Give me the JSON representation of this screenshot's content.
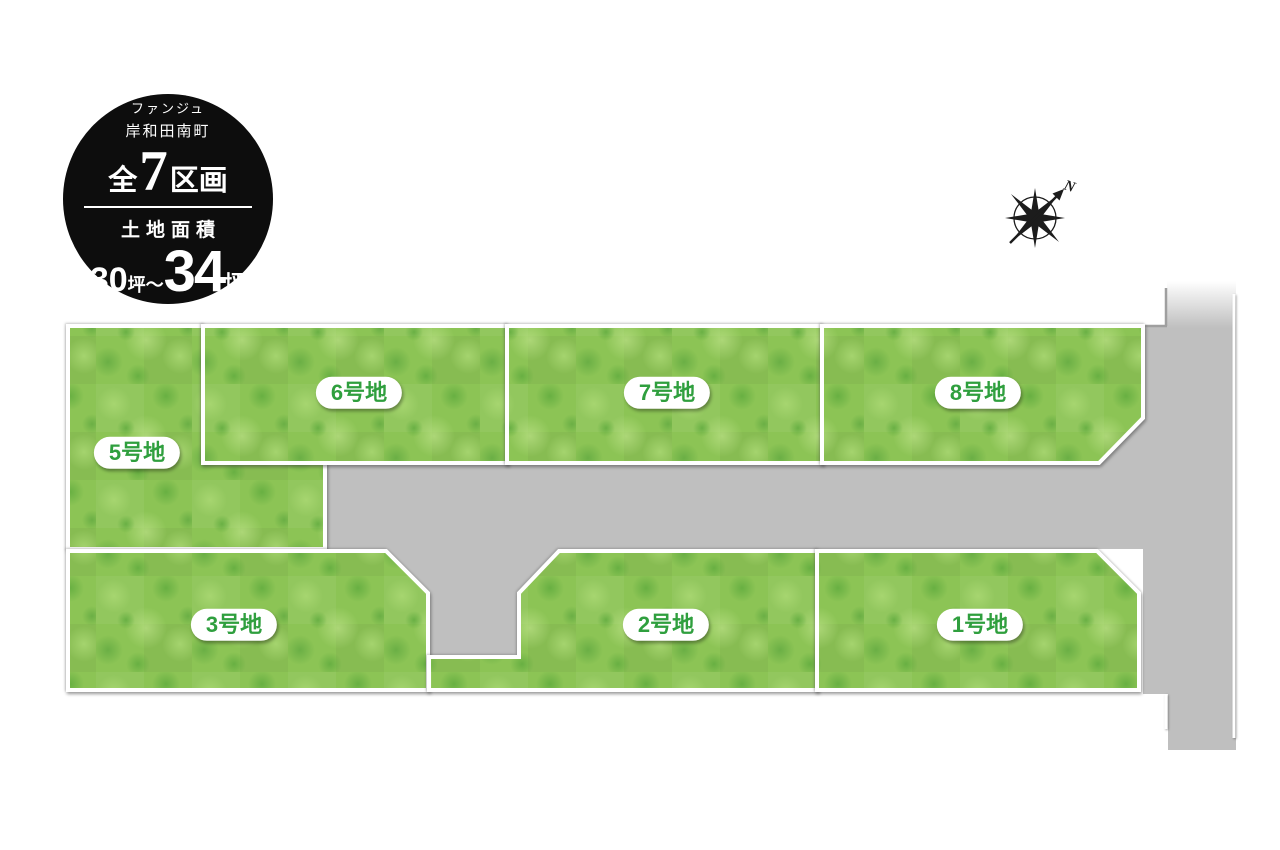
{
  "badge": {
    "brand_line1": "ファンジュ",
    "brand_line2": "岸和田南町",
    "total_prefix": "全",
    "total_count": "7",
    "total_suffix": "区画",
    "area_title": "土地面積",
    "area_min": "30",
    "area_unit_min": "坪",
    "area_range_tilde": "〜",
    "area_max": "34",
    "area_unit_max": "坪"
  },
  "compass": {
    "north_label": "N"
  },
  "lots": [
    {
      "label": "1号地"
    },
    {
      "label": "2号地"
    },
    {
      "label": "3号地"
    },
    {
      "label": "5号地"
    },
    {
      "label": "6号地"
    },
    {
      "label": "7号地"
    },
    {
      "label": "8号地"
    }
  ],
  "colors": {
    "grass_base": "#8cc455",
    "grass_light": "#aad873",
    "grass_dark": "#5ca93c",
    "road": "#bfbfbf",
    "lot_label_green": "#2f9f3e",
    "badge_bg": "#0d0d0d"
  }
}
